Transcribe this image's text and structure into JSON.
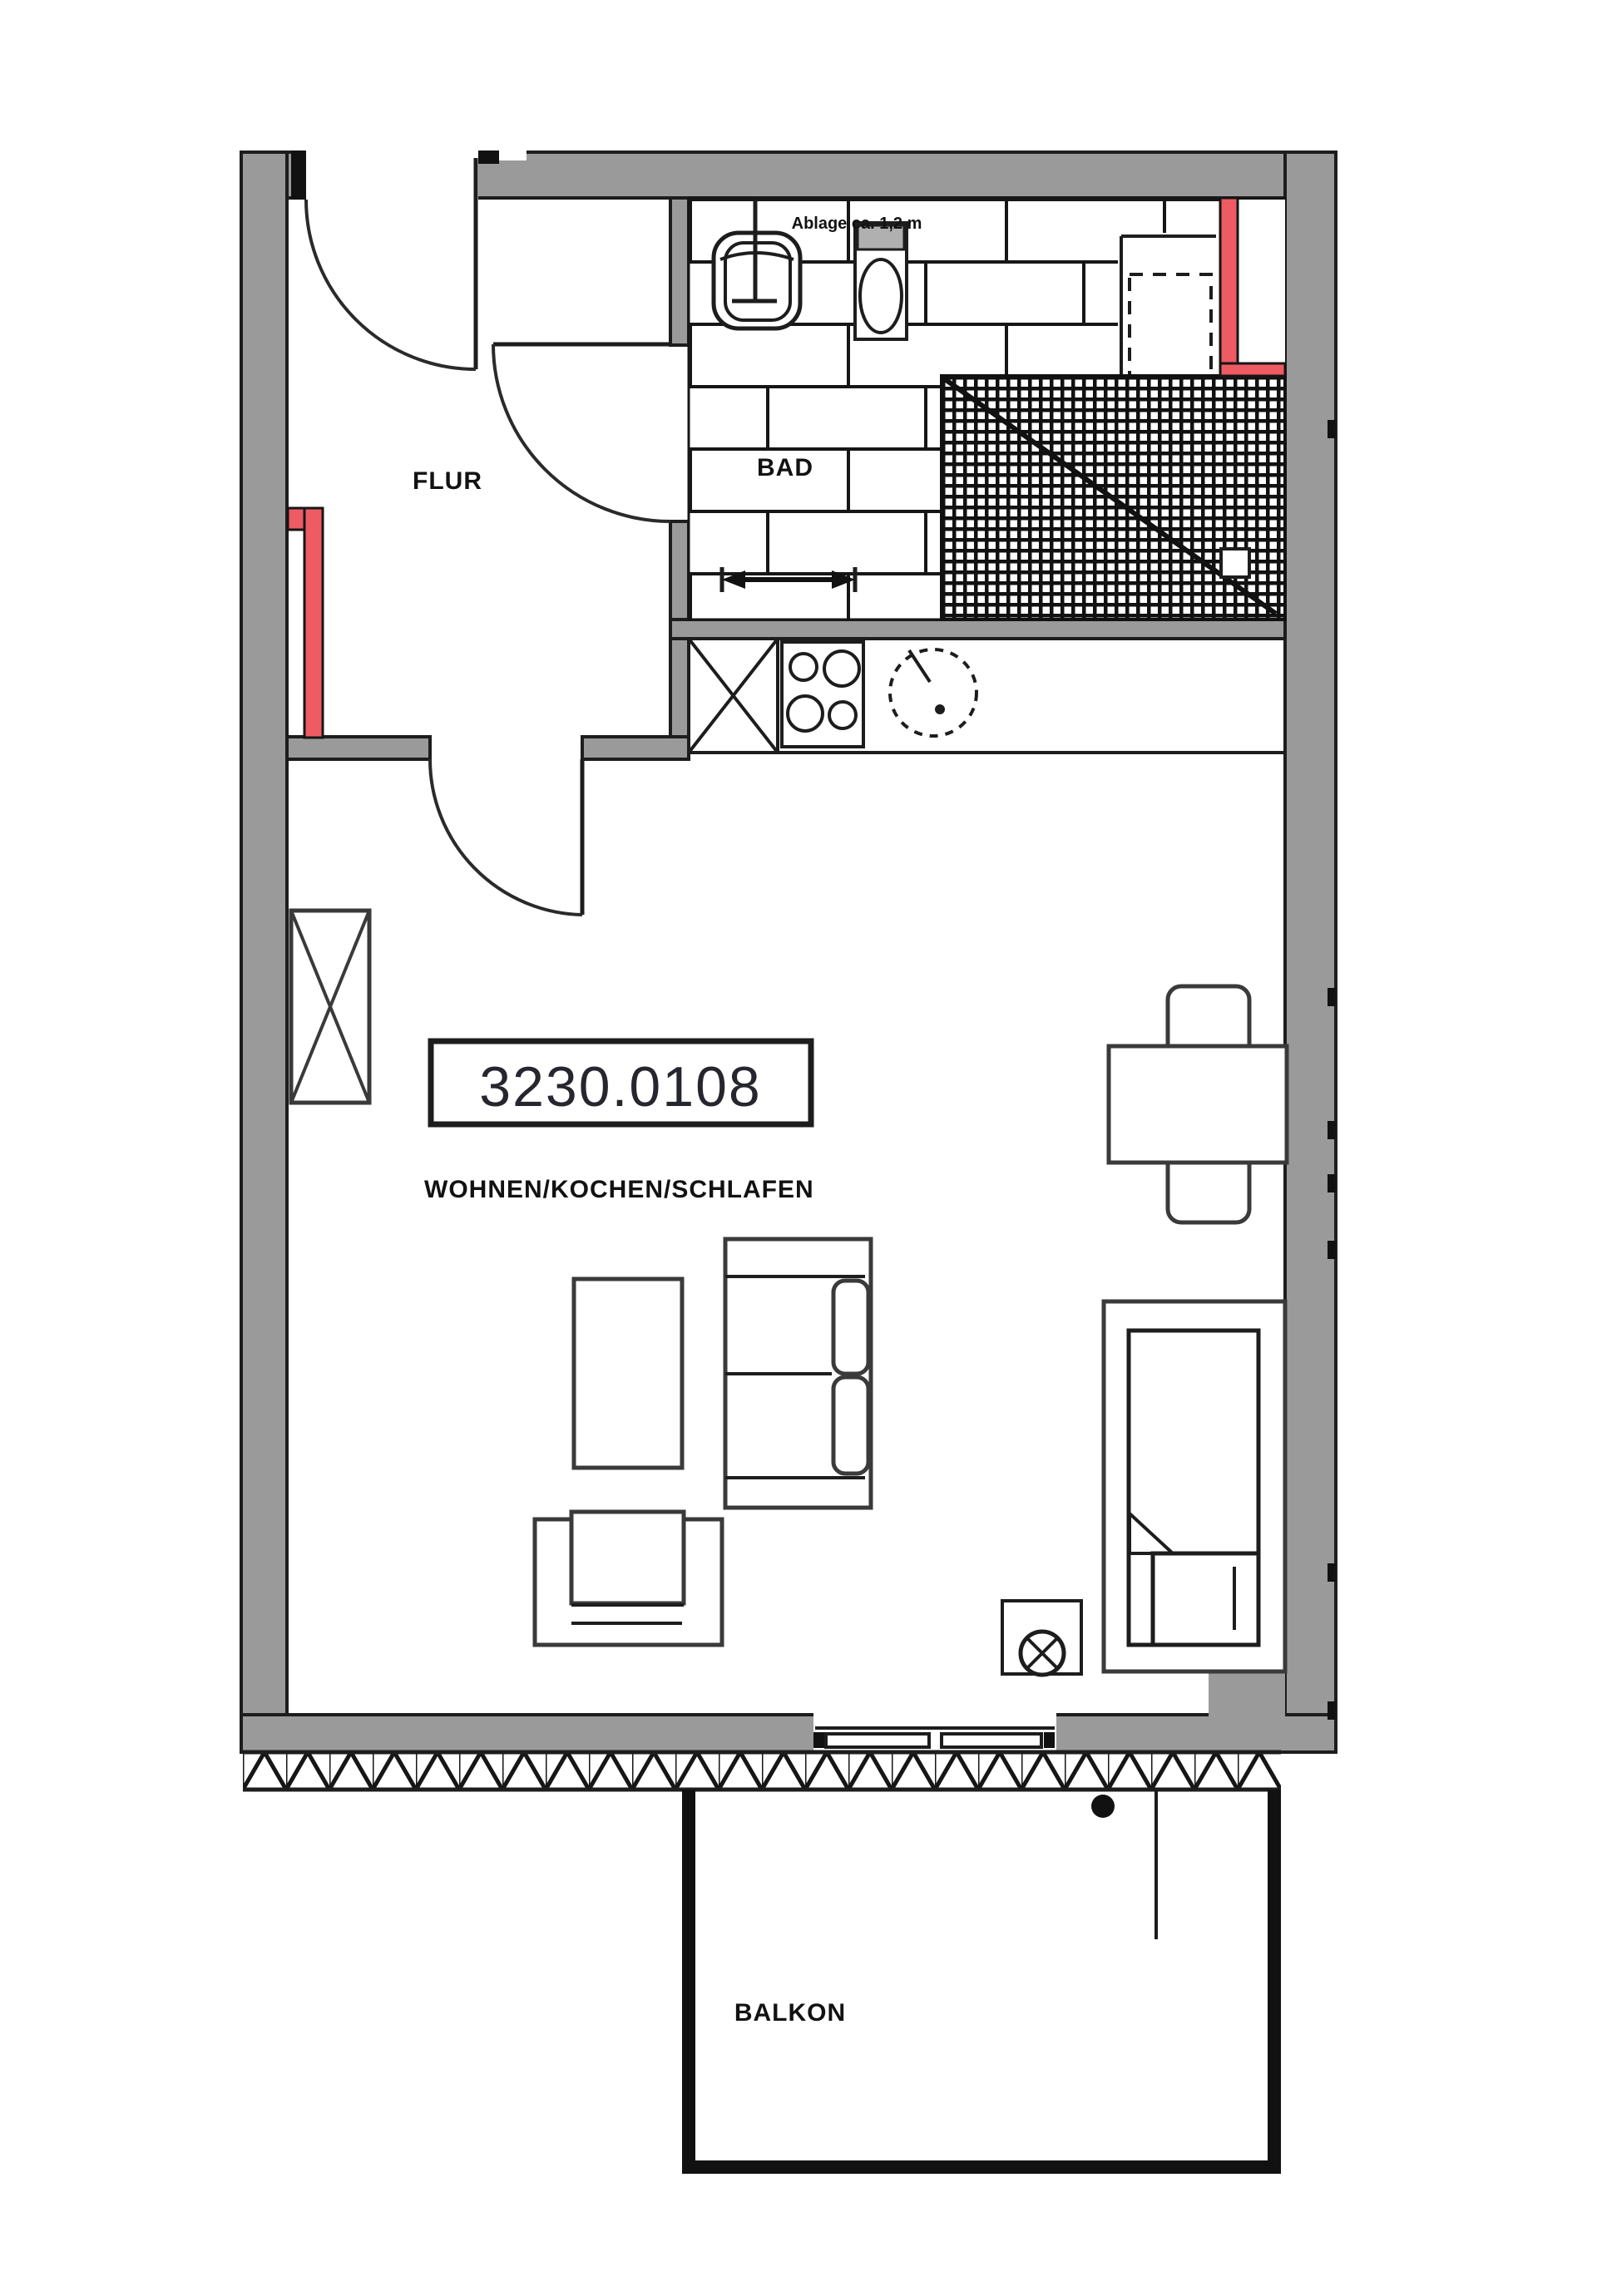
{
  "labels": {
    "flur": "FLUR",
    "bad": "BAD",
    "living": "WOHNEN/KOCHEN/SCHLAFEN",
    "balcony": "BALKON",
    "shelf_note": "Ablage ca. 1,2 m",
    "unit_number": "3230.0108"
  },
  "colors": {
    "wall_gray": "#9a9a9a",
    "line_black": "#1d1d1d",
    "highlight_red": "#ef5b63",
    "toilet_tank_gray": "#b0b0b0",
    "background": "#ffffff"
  },
  "rooms": [
    {
      "name": "FLUR"
    },
    {
      "name": "BAD"
    },
    {
      "name": "WOHNEN/KOCHEN/SCHLAFEN"
    },
    {
      "name": "BALKON"
    }
  ]
}
